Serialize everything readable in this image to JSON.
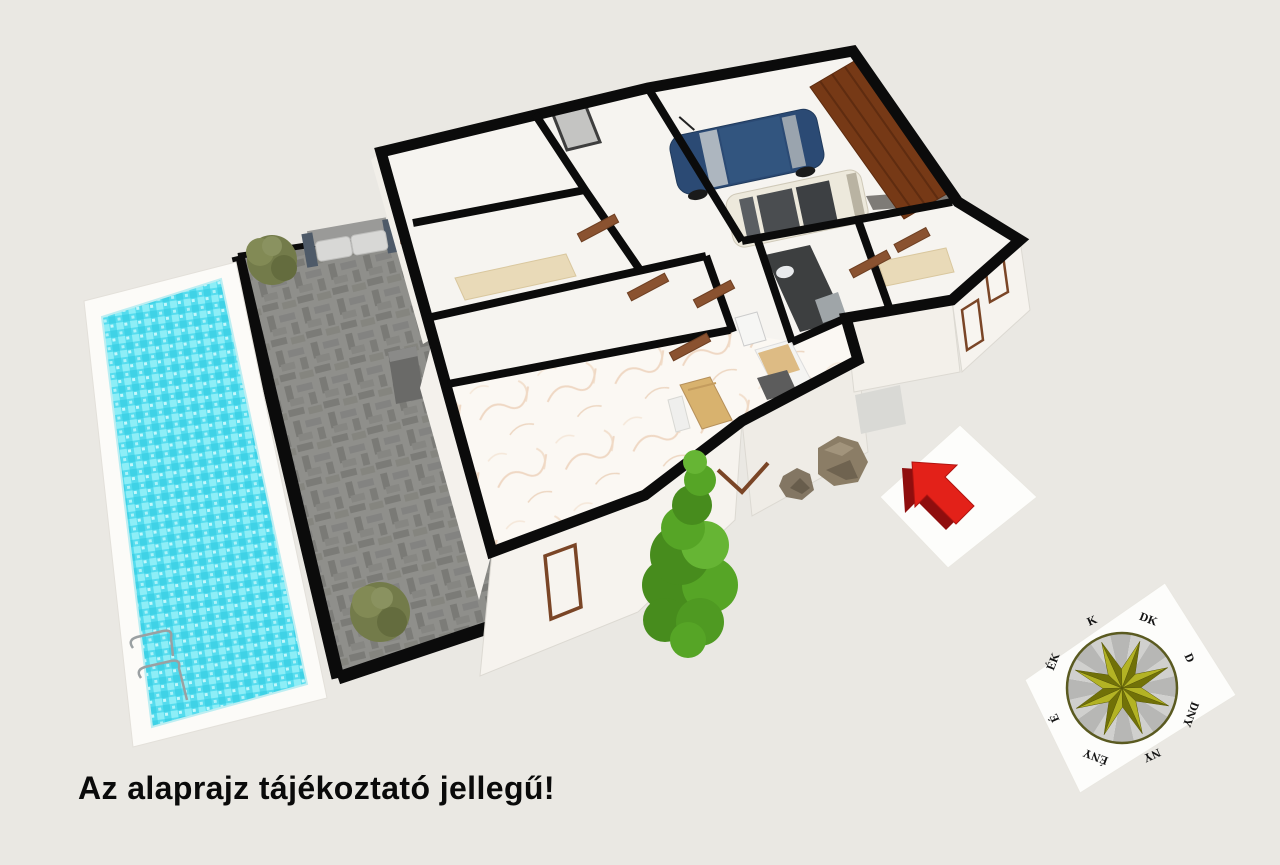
{
  "scene": {
    "kind": "3d-floorplan-render"
  },
  "caption": {
    "text": "Az alaprajz tájékoztató jellegű!"
  },
  "compass": {
    "labels": [
      "K",
      "DK",
      "D",
      "DNY",
      "NY",
      "ÉNY",
      "É",
      "ÉK"
    ],
    "angles": [
      -114,
      -69,
      -24,
      21,
      66,
      111,
      156,
      201
    ],
    "center": [
      1122,
      688
    ],
    "radius": 55,
    "label_radius": 70,
    "star_points": 8
  },
  "objects": {
    "pool": "swimming-pool",
    "terrace": "paved-terrace",
    "bench": "garden-bench",
    "house": "house-floorplan",
    "garage": "garage-with-two-cars",
    "tree": "conifer-tree",
    "rocks": "decorative-rocks",
    "north_arrow": "red-3d-arrow",
    "compass": "compass-rose-hungarian"
  },
  "colors": {
    "bg": "#eae8e3",
    "wall": "#0b0b0b",
    "floor": "#f6f4f0",
    "marble": "#fbf8f3",
    "vein": "#e9cdb4",
    "terrace": "#8f8f8b",
    "paver": "#7b7b77",
    "deck": "#fcfbf8",
    "water": "#55dcee",
    "water2": "#8deef7",
    "water3": "#3fd2e6",
    "door": "#8a5230",
    "garage_door": "#763916",
    "tan": "#e9dab8",
    "bath": "#3d3f40",
    "car_blue": "#2b4a74",
    "car_white": "#ede9dc",
    "glass": "#4a4d50",
    "tree1": "#56a526",
    "tree2": "#478c1d",
    "tree3": "#66b534",
    "shrub": "#737b4a",
    "rock": "#8b7d66",
    "rock_dark": "#6f6350",
    "red": "#e32119",
    "red_dark": "#8f0e0e",
    "card": "#fdfdfb",
    "star_light": "#b3b324",
    "star_dark": "#717108",
    "wedge_light": "#d0d0ce",
    "wedge_dark": "#b7b7b5",
    "bench_seat": "#d8d8d6",
    "bench_frame": "#4e5a68",
    "gray_box": "#6a6a68"
  }
}
